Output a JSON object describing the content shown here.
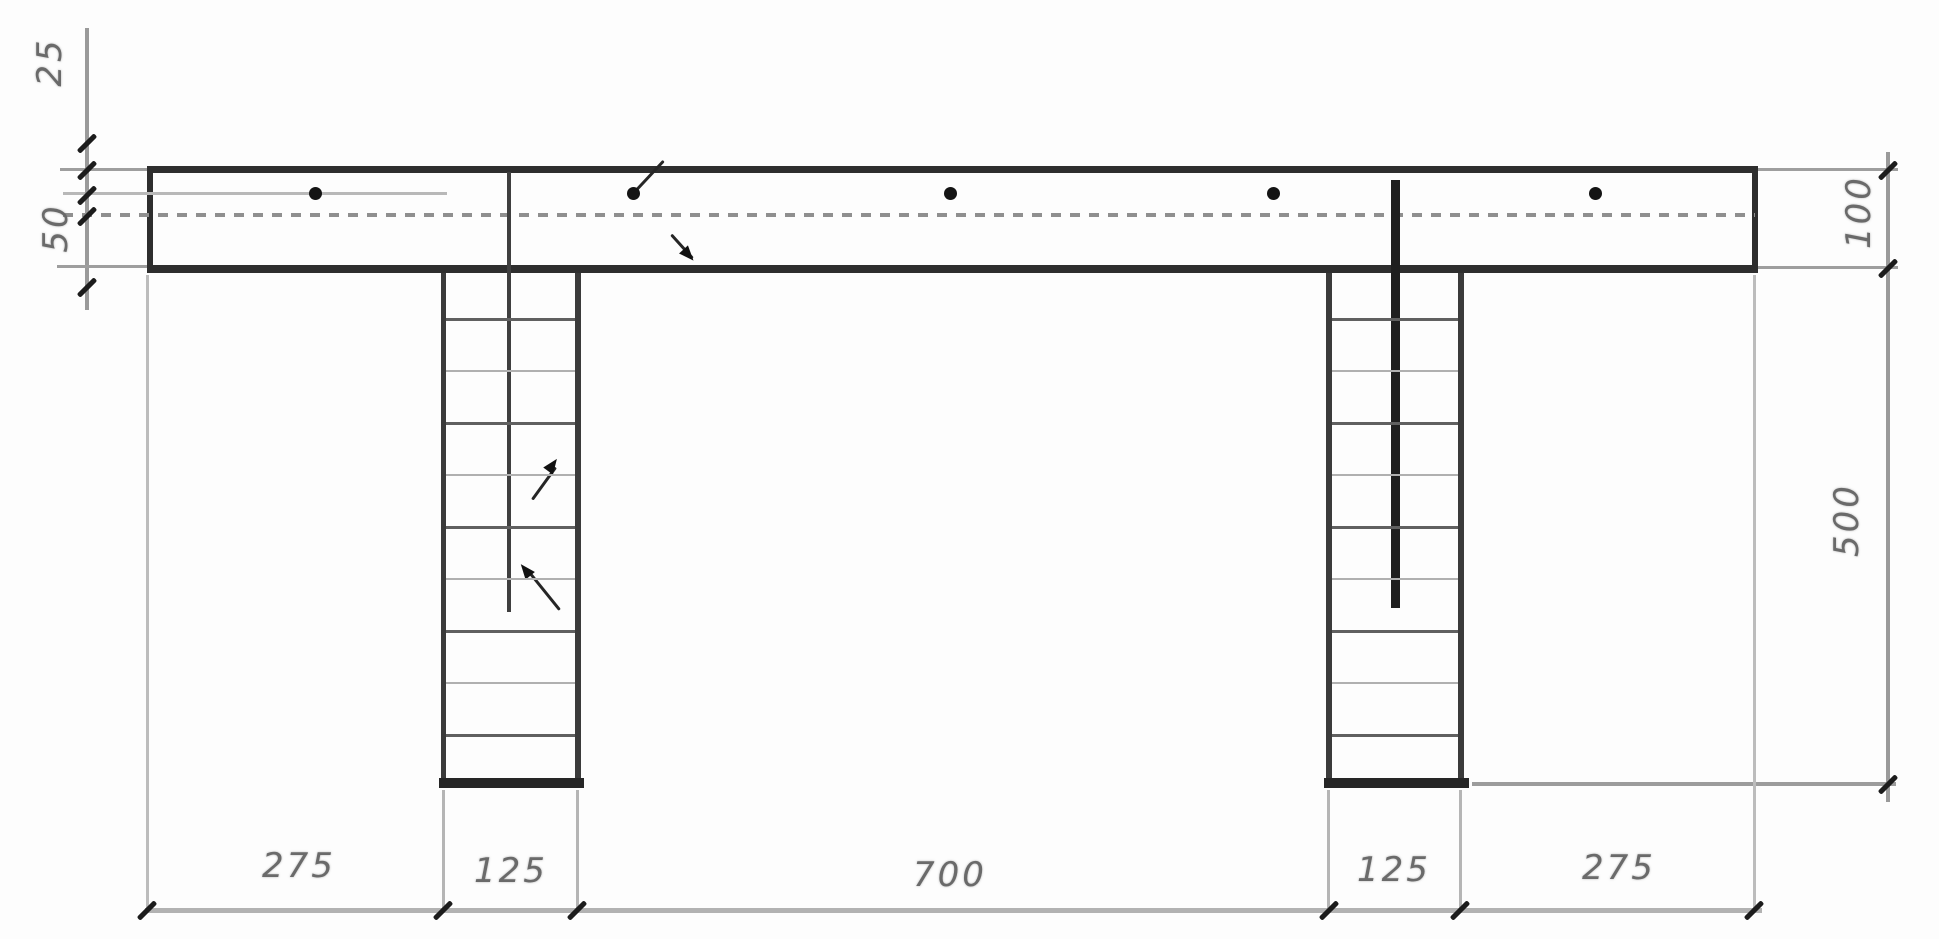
{
  "dims": {
    "bottom": [
      "275",
      "125",
      "700",
      "125",
      "275"
    ],
    "left": [
      "25",
      "50"
    ],
    "right": [
      "100",
      "500"
    ]
  },
  "line_color": "#2e2e2e",
  "dim_line_color": "#9a9a9a",
  "label_color": "#6a6a6a"
}
